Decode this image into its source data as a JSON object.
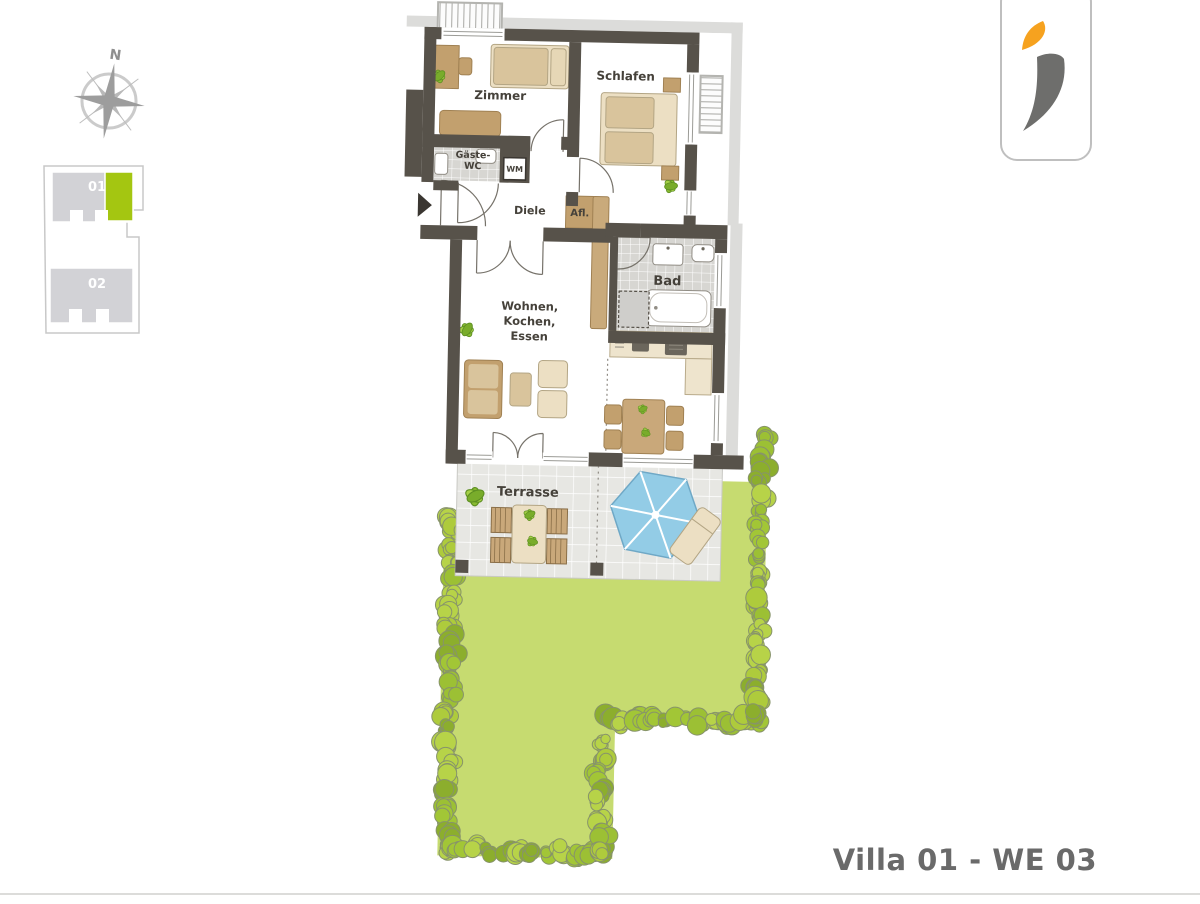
{
  "header": {
    "title": "Villa 01 - WE 03"
  },
  "compass": {
    "north": "N"
  },
  "site_plan": {
    "building_01": "01",
    "building_02": "02"
  },
  "rooms": {
    "zimmer": "Zimmer",
    "schlafen": "Schlafen",
    "gaeste_wc_1": "Gäste-",
    "gaeste_wc_2": "WC",
    "wm": "WM",
    "diele": "Diele",
    "afl": "Afl.",
    "bad": "Bad",
    "wohnen_1": "Wohnen,",
    "wohnen_2": "Kochen,",
    "wohnen_3": "Essen",
    "terrasse": "Terrasse"
  },
  "colors": {
    "wall": "#57524a",
    "garden": "#c6db70",
    "unit_highlight": "#a4c611",
    "logo_orange": "#f6a21f",
    "logo_gray": "#6e6e6c",
    "umbrella_blue": "#93cce6"
  }
}
